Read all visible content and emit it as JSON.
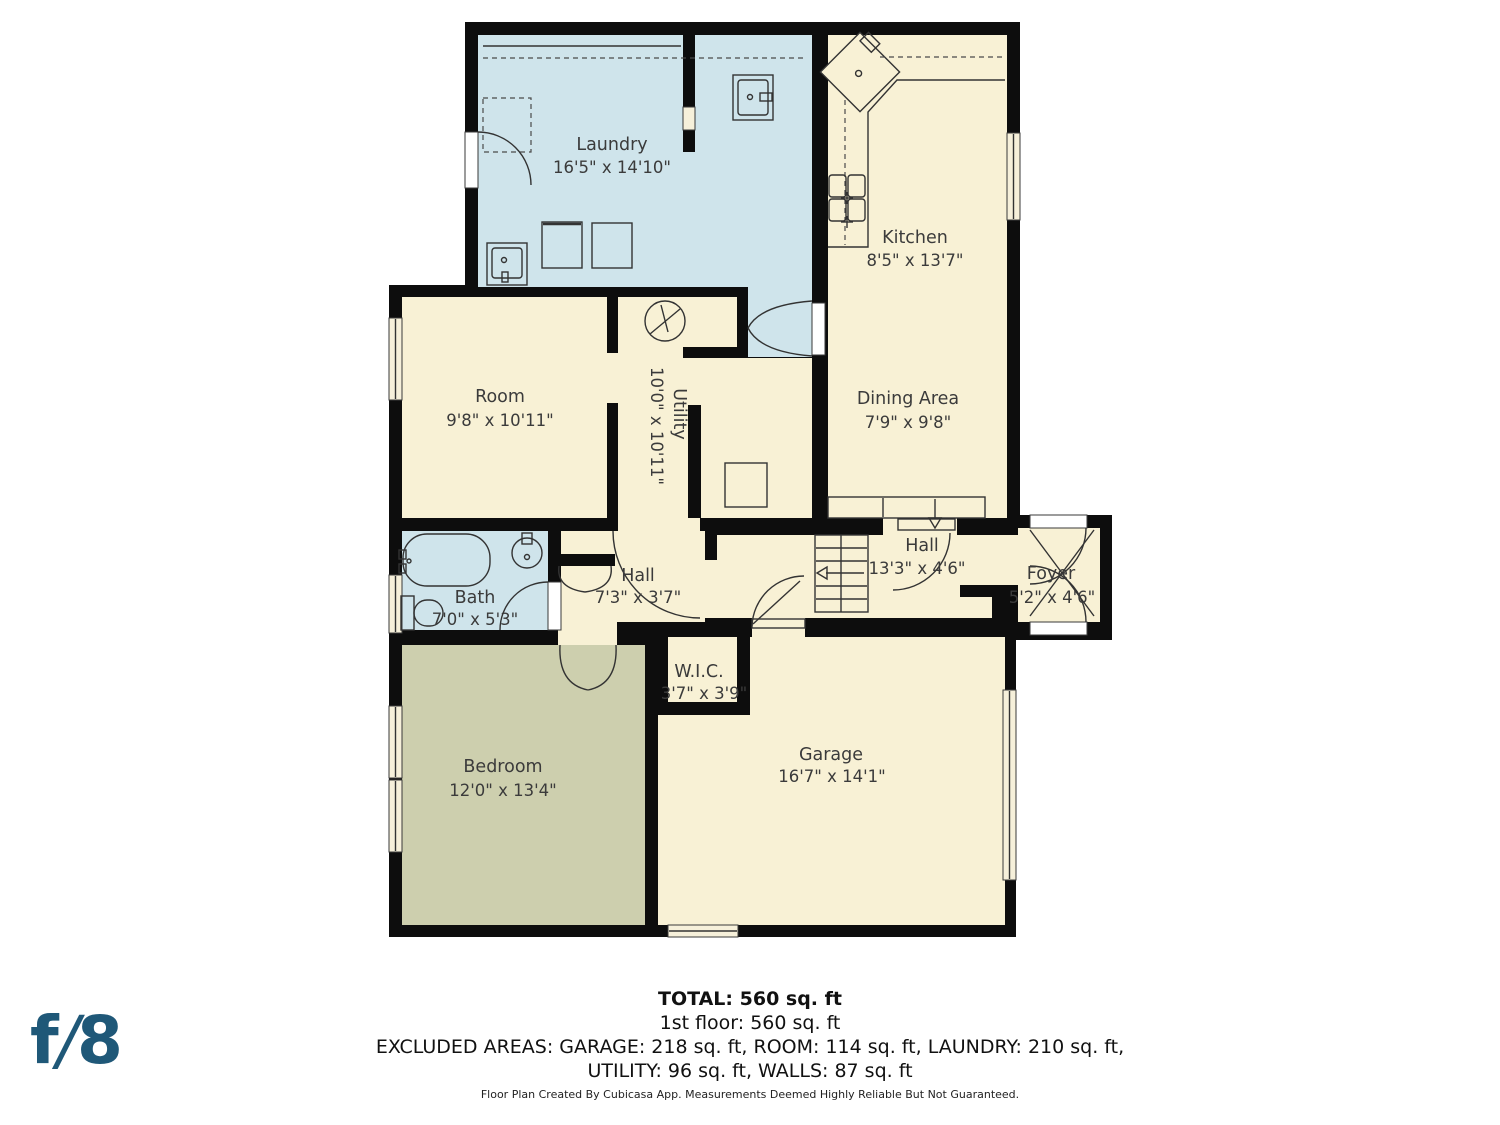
{
  "colors": {
    "wall": "#0d0d0d",
    "cream": "#f8f1d5",
    "water": "#cfe4eb",
    "green": "#cdcfae",
    "line": "#333333",
    "logo": "#1f5878"
  },
  "rooms": [
    {
      "name": "Laundry",
      "dims": "16'5\" x 14'10\""
    },
    {
      "name": "Kitchen",
      "dims": "8'5\" x 13'7\""
    },
    {
      "name": "Dining Area",
      "dims": "7'9\" x 9'8\""
    },
    {
      "name": "Room",
      "dims": "9'8\" x 10'11\""
    },
    {
      "name": "Utility",
      "dims": "10'0\" x 10'11\""
    },
    {
      "name": "Hall",
      "dims": "13'3\" x 4'6\""
    },
    {
      "name": "Foyer",
      "dims": "5'2\" x 4'6\""
    },
    {
      "name": "Bath",
      "dims": "7'0\" x 5'3\""
    },
    {
      "name": "Hall",
      "dims": "7'3\" x 3'7\""
    },
    {
      "name": "W.I.C.",
      "dims": "3'7\" x 3'9\""
    },
    {
      "name": "Bedroom",
      "dims": "12'0\" x 13'4\""
    },
    {
      "name": "Garage",
      "dims": "16'7\" x 14'1\""
    }
  ],
  "summary": {
    "total": "TOTAL: 560 sq. ft",
    "floor": "1st floor: 560 sq. ft",
    "excluded_line1": "EXCLUDED AREAS: GARAGE: 218 sq. ft, ROOM: 114 sq. ft, LAUNDRY: 210 sq. ft,",
    "excluded_line2": "UTILITY: 96 sq. ft, WALLS: 87 sq. ft",
    "disclaimer": "Floor Plan Created By Cubicasa App. Measurements Deemed Highly Reliable But Not Guaranteed."
  },
  "logo": {
    "f": "f",
    "slash": "/",
    "eight": "8"
  }
}
